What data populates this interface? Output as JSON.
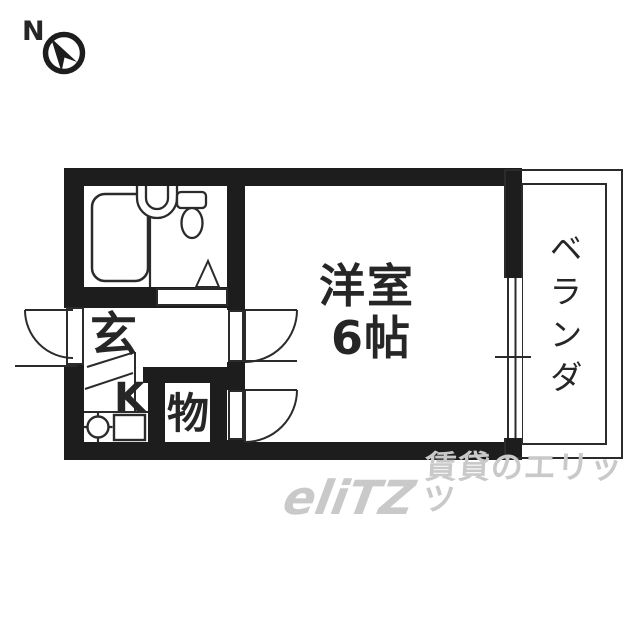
{
  "compass": {
    "north_label": "N"
  },
  "plan": {
    "main_room": {
      "name": "洋室",
      "size": "6帖"
    },
    "entrance": {
      "label": "玄"
    },
    "kitchen": {
      "label": "K"
    },
    "closet": {
      "label": "物"
    },
    "balcony": {
      "label": "ベランダ"
    }
  },
  "watermark": {
    "logo": "eliTZ",
    "caption": "賃貸のエリッツ"
  },
  "colors": {
    "wall": "#1d1d1d",
    "line": "#2b2b2b",
    "watermark": "#c9c9c9",
    "background": "#ffffff"
  }
}
